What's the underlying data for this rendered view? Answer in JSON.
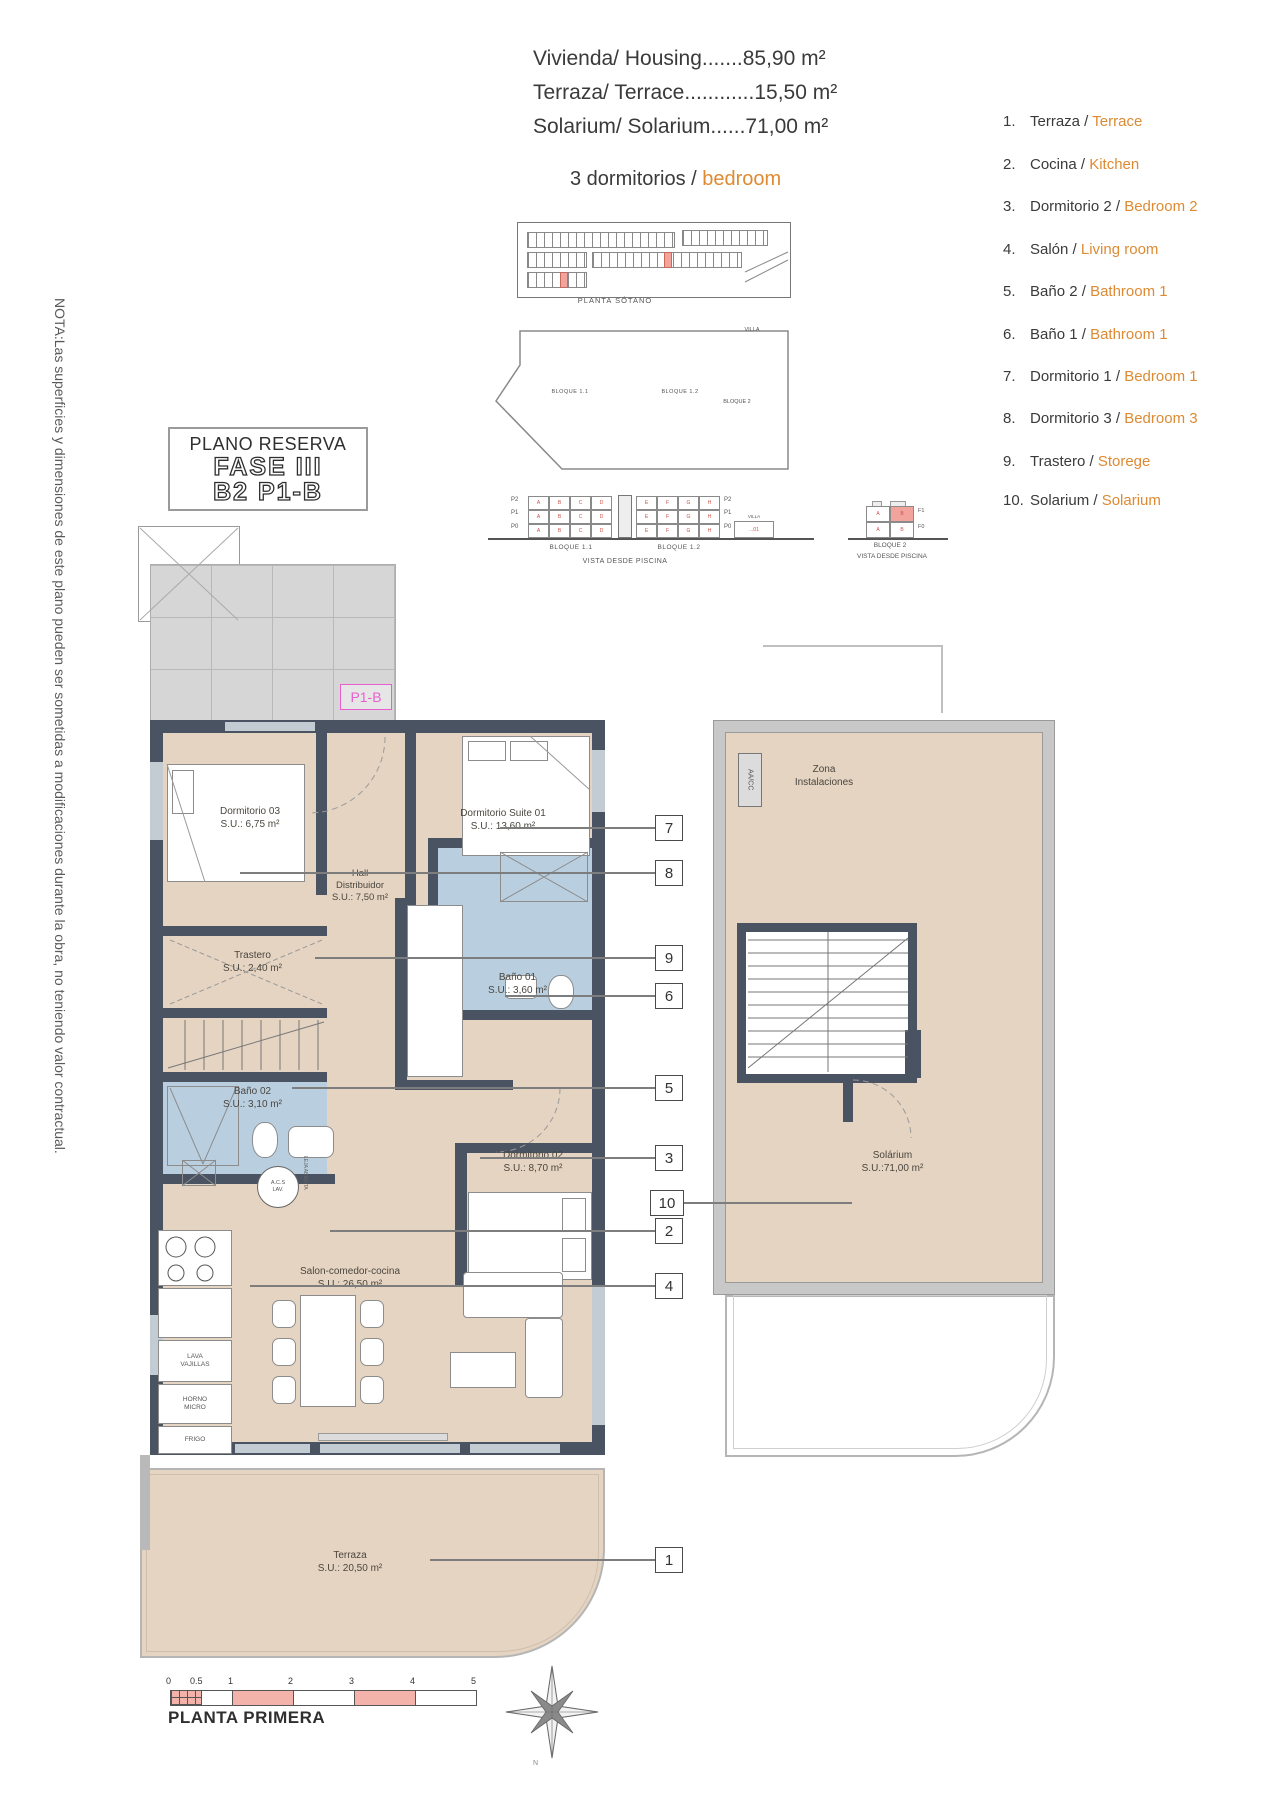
{
  "summary": {
    "line1": "Vivienda/ Housing.......85,90 m²",
    "line2": "Terraza/ Terrace............15,50 m²",
    "line3": "Solarium/ Solarium......71,00 m²",
    "bedrooms_es": "3 dormitorios / ",
    "bedrooms_en": "bedroom"
  },
  "reserve": {
    "title": "PLANO RESERVA",
    "phase": "FASE III",
    "unit": "B2 P1-B"
  },
  "note": "NOTA:Las superficies y dimensiones de este plano pueden ser sometidas a modificaciones durante la obra, no teniendo valor contractual.",
  "legend": {
    "items": [
      {
        "num": "1.",
        "es": "Terraza /",
        "en": "Terrace"
      },
      {
        "num": "2.",
        "es": "Cocina /",
        "en": "Kitchen"
      },
      {
        "num": "3.",
        "es": "Dormitorio 2 /",
        "en": "Bedroom 2"
      },
      {
        "num": "4.",
        "es": "Salón /",
        "en": "Living room"
      },
      {
        "num": "5.",
        "es": "Baño 2 /",
        "en": "Bathroom 1"
      },
      {
        "num": "6.",
        "es": "Baño 1 /",
        "en": "Bathroom 1"
      },
      {
        "num": "7.",
        "es": "Dormitorio 1 /",
        "en": "Bedroom 1"
      },
      {
        "num": "8.",
        "es": "Dormitorio 3 /",
        "en": "Bedroom 3"
      },
      {
        "num": "9.",
        "es": "Trastero /",
        "en": "Storege"
      },
      {
        "num": "10.",
        "es": "Solarium /",
        "en": "Solarium"
      }
    ]
  },
  "site": {
    "basement_label": "PLANTA SÓTANO",
    "bloque11": "BLOQUE 1.1",
    "bloque12": "BLOQUE 1.2",
    "bloque2": "BLOQUE 2",
    "villa": "VILLA",
    "piscina": "PISCINA",
    "villa_unit": "...01",
    "units_row1": [
      "A",
      "B",
      "C",
      "D"
    ],
    "units_row2": [
      "E",
      "F",
      "G",
      "H"
    ],
    "elev_floors": [
      "P2",
      "P1",
      "P0"
    ],
    "elev2_floors": [
      "F1",
      "F0"
    ],
    "elev2_units": [
      "A",
      "B"
    ],
    "vista": "VISTA DESDE PISCINA"
  },
  "plan": {
    "p1b": "P1-B",
    "dorm03": {
      "name": "Dormitorio 03",
      "area": "S.U.: 6,75 m²"
    },
    "suite01": {
      "name": "Dormitorio Suite 01",
      "area": "S.U.: 13,60 m²"
    },
    "hall": {
      "l1": "Hall",
      "l2": "Distribuidor",
      "area": "S.U.: 7,50 m²"
    },
    "trastero": {
      "name": "Trastero",
      "area": "S.U.: 2,40 m²"
    },
    "bano01": {
      "name": "Baño 01",
      "area": "S.U.: 3,60 m²"
    },
    "bano02": {
      "name": "Baño 02",
      "area": "S.U.: 3,10 m²"
    },
    "dorm02": {
      "name": "Dormitorio 02",
      "area": "S.U.: 8,70 m²"
    },
    "salon": {
      "name": "Salon-comedor-cocina",
      "area": "S.U.: 26,50 m²"
    },
    "terraza": {
      "name": "Terraza",
      "area": "S.U.: 20,50 m²"
    },
    "acs1": "A.C.S",
    "acs2": "LAV.",
    "lava1": "LAVA",
    "lava2": "VAJILLAS",
    "horno1": "HORNO",
    "horno2": "MICRO",
    "frigo": "FRIGO",
    "leja": "LEJA ABIERTA"
  },
  "solarium": {
    "zona1": "Zona",
    "zona2": "Instalaciones",
    "aacc": "AA/CC",
    "name": "Solárium",
    "area": "S.U.:71,00 m²"
  },
  "callouts": [
    "7",
    "8",
    "9",
    "6",
    "5",
    "3",
    "10",
    "2",
    "4",
    "1"
  ],
  "footer": {
    "ticks": [
      "0",
      "0.5",
      "1",
      "2",
      "3",
      "4",
      "5"
    ],
    "title": "PLANTA PRIMERA",
    "north": "N"
  },
  "colors": {
    "accent": "#dd8a33",
    "wall": "#4a5361",
    "floor": "#e5d4c1",
    "bath": "#b9cfe0",
    "highlight": "#f2a49c",
    "magenta": "#e95fd0"
  }
}
